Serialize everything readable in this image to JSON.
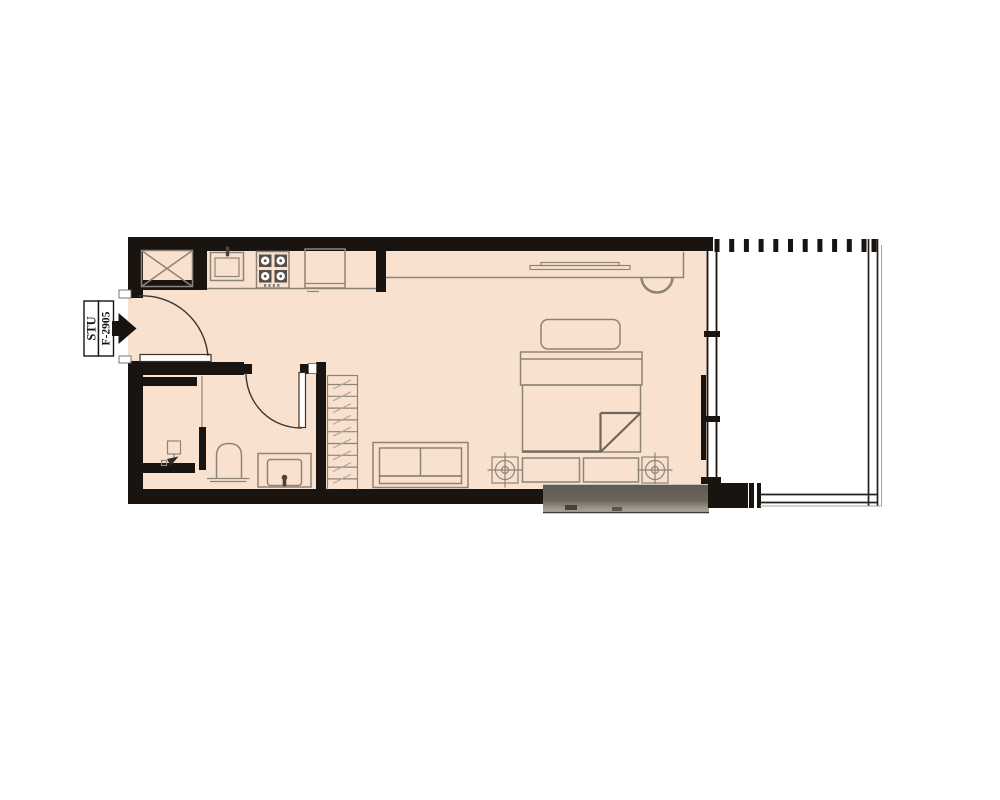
{
  "unit_label": {
    "type": "STU",
    "number": "F-2905"
  },
  "colors": {
    "floor": "#f9e1cf",
    "wall": "#1a1410",
    "furniture-line": "#8d8479",
    "furniture-dark": "#6e665d",
    "arc": "#3c332a",
    "slab-top": "#5e5952",
    "slab-light": "#948d83",
    "slab-bottom": "#b5aea1"
  },
  "fixtures": [
    "washer-shaft",
    "kitchen-sink",
    "cooktop-4-burner",
    "refrigerator",
    "kitchen-counter",
    "entry-door",
    "study-desk",
    "tv",
    "desk-chair",
    "bed",
    "pillow",
    "headboard",
    "blanket-fold",
    "side-table-left",
    "side-table-right",
    "foot-bench",
    "sofa",
    "wardrobe",
    "bathroom-door",
    "shower",
    "toilet",
    "vanity-sink",
    "window-wall",
    "balcony",
    "balcony-railing",
    "louver-hatch",
    "ac-ledge"
  ]
}
